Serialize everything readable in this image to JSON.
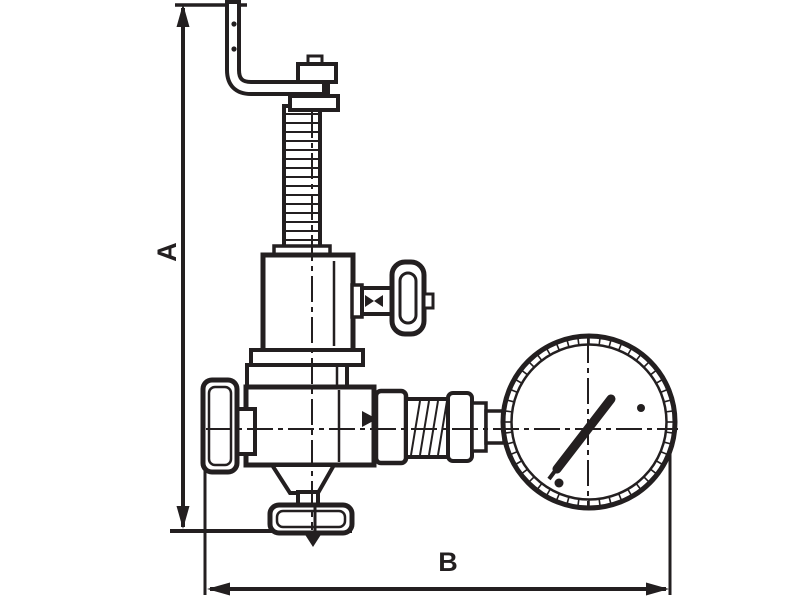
{
  "drawing": {
    "type": "valve-dimension-diagram",
    "ink_color": "#231f20",
    "background_color": "#ffffff"
  },
  "dimensions": {
    "a": {
      "label": "A",
      "orientation": "vertical"
    },
    "b": {
      "label": "B",
      "orientation": "horizontal"
    }
  },
  "parts": {
    "lever": "lifting-lever-handle",
    "screw": "threaded-adjusting-screw",
    "housing": "spring-housing",
    "side_valve": "shutoff-handwheel",
    "body": "valve-body",
    "inlet": "inlet-union",
    "gauge_line": "gauge-connection-fittings",
    "gauge": "pressure-gauge",
    "outlet": "bottom-outlet-flange"
  }
}
